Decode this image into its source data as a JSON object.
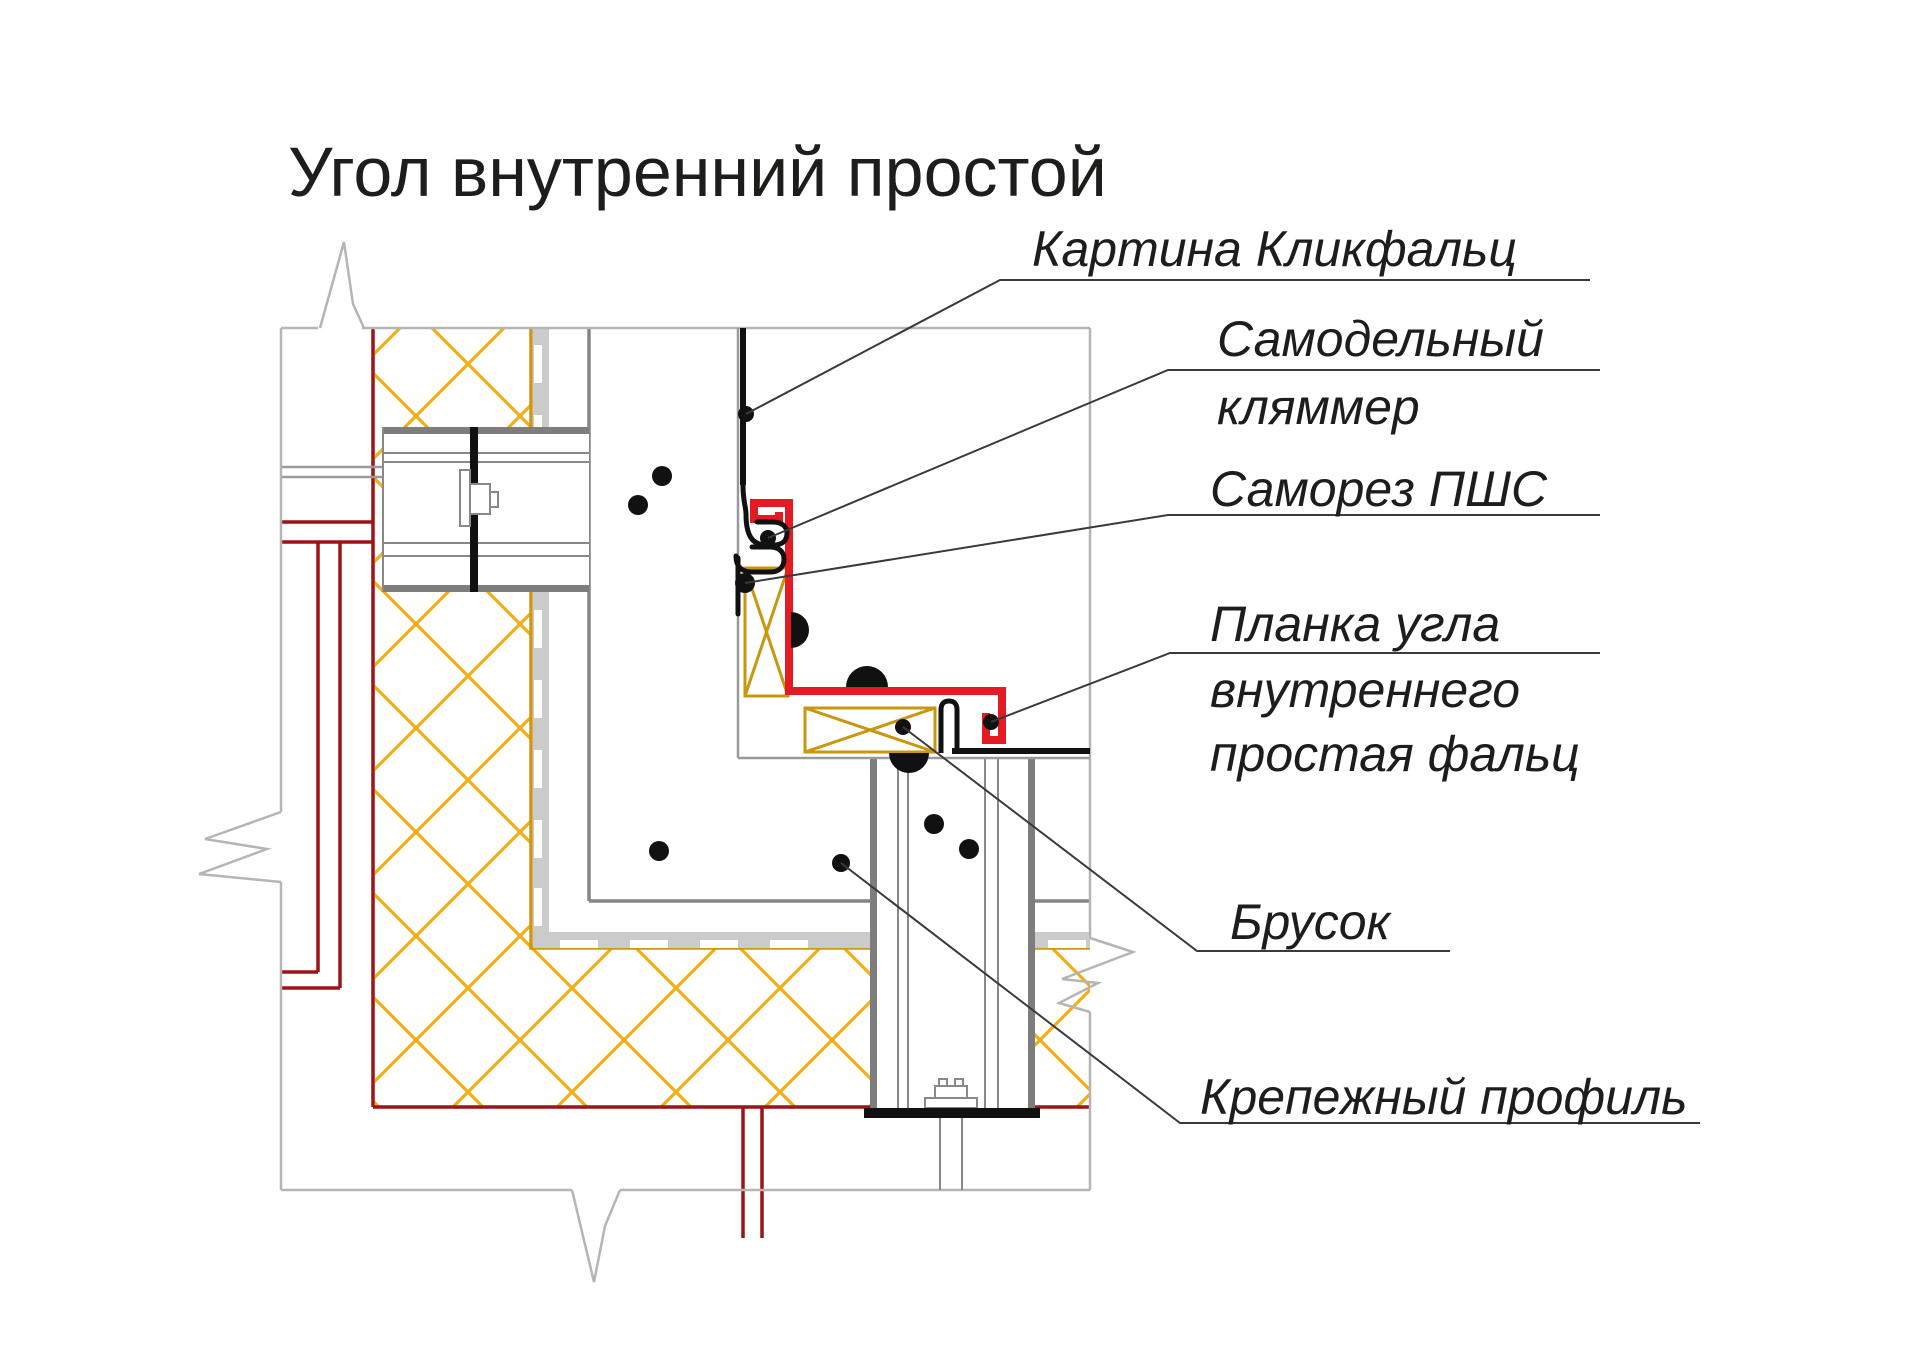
{
  "title": "Угол внутренний простой",
  "callouts": {
    "kartina": {
      "lines": [
        "Картина Кликфальц"
      ]
    },
    "klyammer": {
      "lines": [
        "Самодельный",
        "кляммер"
      ]
    },
    "samorez": {
      "lines": [
        "Саморез ПШС"
      ]
    },
    "planka": {
      "lines": [
        "Планка угла",
        "внутреннего",
        "простая фальц"
      ]
    },
    "brusok": {
      "lines": [
        "Брусок"
      ]
    },
    "profil": {
      "lines": [
        "Крепежный профиль"
      ]
    }
  },
  "colors": {
    "corner_strip_red": "#e41b23",
    "vapor_barrier_dark_red": "#9e1317",
    "insulation_yellow": "#f2ae17",
    "insulation_edge_dark_yellow": "#cf9616",
    "membrane_gray": "#cbcbcb",
    "outline_gray": "#b5b5b5",
    "steel_gray": "#7d7d7d",
    "panel_black": "#111111",
    "text_color": "#1d1d1b"
  }
}
